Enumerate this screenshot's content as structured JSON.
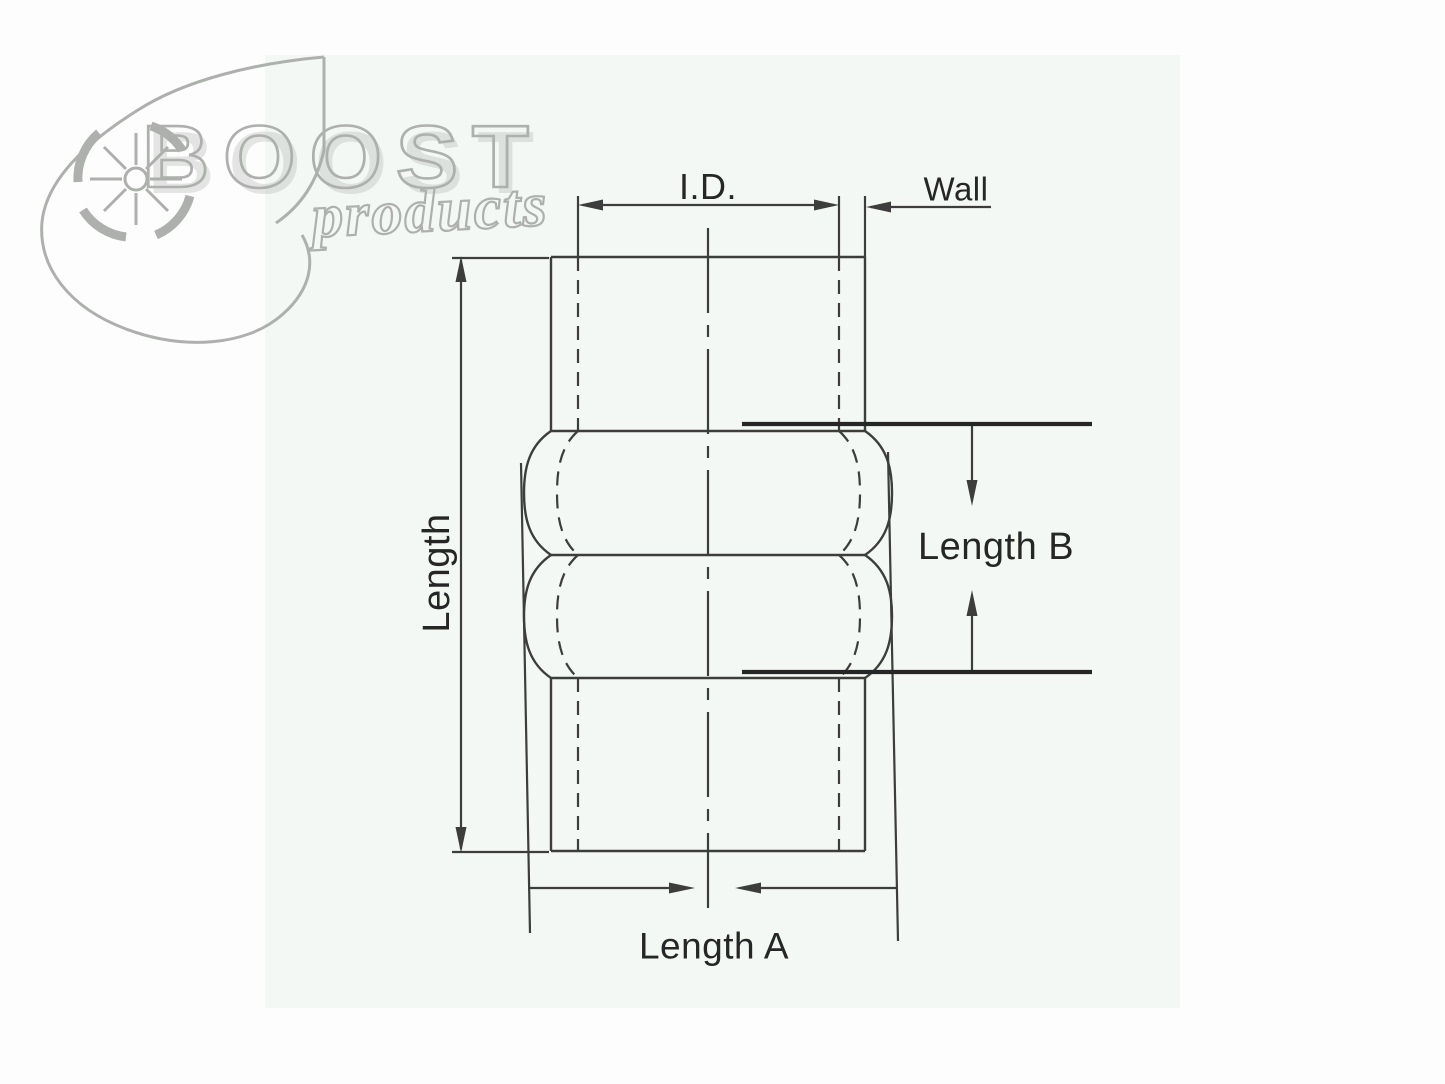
{
  "page": {
    "canvas_bg": "#fdfdfd",
    "photo_area_bg": "#f4f8f4"
  },
  "logo": {
    "brand": "BOOST",
    "brand_sub": "products",
    "outline_color": "#aeb0ae",
    "icon": "turbo-icon"
  },
  "diagram": {
    "subject": "hump hose coupler dimension drawing",
    "line_color": "#3d3d3d",
    "ref_line_color": "#262626",
    "labels": {
      "inner_diameter": "I.D.",
      "wall": "Wall",
      "length": "Length",
      "length_a": "Length A",
      "length_b": "Length B"
    }
  }
}
